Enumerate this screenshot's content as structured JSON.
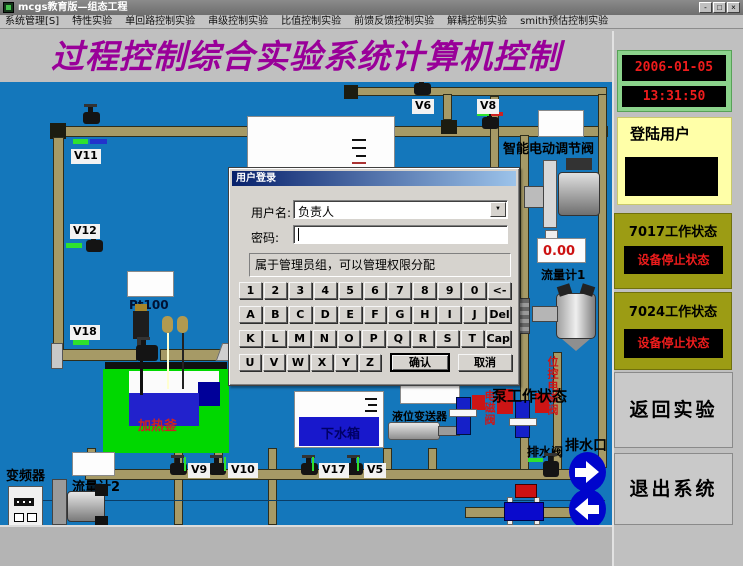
{
  "window": {
    "title": "mcgs教育版—组态工程",
    "minimize": "-",
    "maximize": "□",
    "close": "×"
  },
  "menu": {
    "items": [
      "系统管理[S]",
      "特性实验",
      "单回路控制实验",
      "串级控制实验",
      "比值控制实验",
      "前馈反馈控制实验",
      "解耦控制实验",
      "smith预估控制实验"
    ]
  },
  "header": {
    "title": "过程控制综合实验系统计算机控制"
  },
  "right_panel": {
    "date": "2006-01-05",
    "time": "13:31:50",
    "login_label": "登陆用户",
    "status_7017": {
      "title": "7017工作状态",
      "value": "设备停止状态"
    },
    "status_7024": {
      "title": "7024工作状态",
      "value": "设备停止状态"
    },
    "back_button": "返回实验",
    "exit_button": "退出系统"
  },
  "dialog": {
    "title": "用户登录",
    "username_label": "用户名:",
    "username_value": "负责人",
    "password_label": "密码:",
    "password_value": "",
    "info_text": "属于管理员组，可以管理权限分配",
    "keyboard": {
      "rows": [
        [
          "1",
          "2",
          "3",
          "4",
          "5",
          "6",
          "7",
          "8",
          "9",
          "0",
          "<-"
        ],
        [
          "A",
          "B",
          "C",
          "D",
          "E",
          "F",
          "G",
          "H",
          "I",
          "J",
          "Del"
        ],
        [
          "K",
          "L",
          "M",
          "N",
          "O",
          "P",
          "Q",
          "R",
          "S",
          "T",
          "Cap"
        ],
        [
          "U",
          "V",
          "W",
          "X",
          "Y",
          "Z"
        ]
      ],
      "confirm": "确认",
      "cancel": "取消"
    }
  },
  "diagram": {
    "valves": {
      "v11": "V11",
      "v12": "V12",
      "v18": "V18",
      "v6": "V6",
      "v8": "V8",
      "v9": "V9",
      "v10": "V10",
      "v17": "V17",
      "v5": "V5"
    },
    "labels": {
      "pt100": "Pt100",
      "smart_valve": "智能电动调节阀",
      "flow_display": "0.00",
      "flowmeter1": "流量计1",
      "pos_solenoid": "位控电磁阀",
      "solenoid": "电磁阀",
      "pump_status": "泵工作状态",
      "drain_valve": "排水阀",
      "drain_outlet": "排水口",
      "heater": "加热釜",
      "lower_tank": "下水箱",
      "level_transmitter": "液位变送器",
      "inverter": "变频器",
      "flowmeter2": "流量计2"
    },
    "colors": {
      "canvas_blue": "#1477bb",
      "pipe_tan": "#a69a66",
      "title_purple": "#990099",
      "status_red": "#ee1c1c",
      "panel_green": "#8cd38c",
      "panel_yellow": "#ffffa8",
      "panel_olive": "#9c9c14",
      "tank_green": "#00d800",
      "liquid_blue": "#2222cc"
    }
  }
}
